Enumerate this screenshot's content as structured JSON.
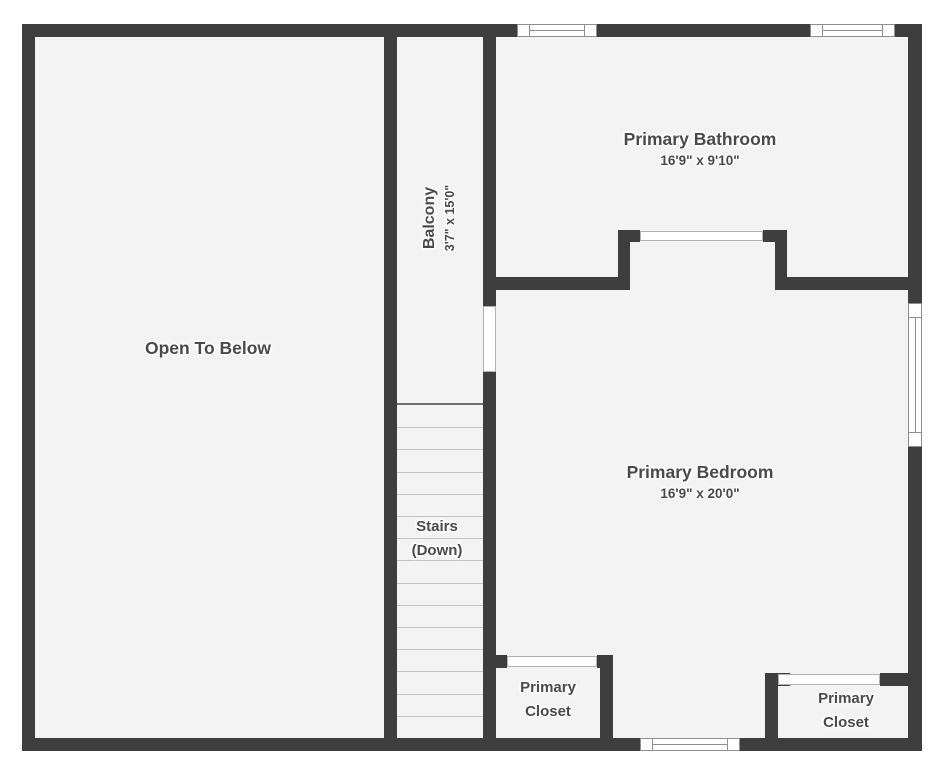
{
  "colors": {
    "background": "#ffffff",
    "floor": "#f3f3f3",
    "wall": "#3e3e3e",
    "text": "#4a4a4a",
    "tread": "#c2c2c2",
    "winline": "#8f8f8f"
  },
  "rooms": {
    "open_to_below": {
      "label": "Open To Below"
    },
    "balcony": {
      "label": "Balcony",
      "dims": "3'7\" x 15'0\""
    },
    "bathroom": {
      "label": "Primary Bathroom",
      "dims": "16'9\" x 9'10\""
    },
    "bedroom": {
      "label": "Primary Bedroom",
      "dims": "16'9\" x 20'0\""
    },
    "stairs": {
      "line1": "Stairs",
      "line2": "(Down)",
      "tread_count": 14
    },
    "closet_left": {
      "line1": "Primary",
      "line2": "Closet"
    },
    "closet_right": {
      "line1": "Primary",
      "line2": "Closet"
    }
  }
}
